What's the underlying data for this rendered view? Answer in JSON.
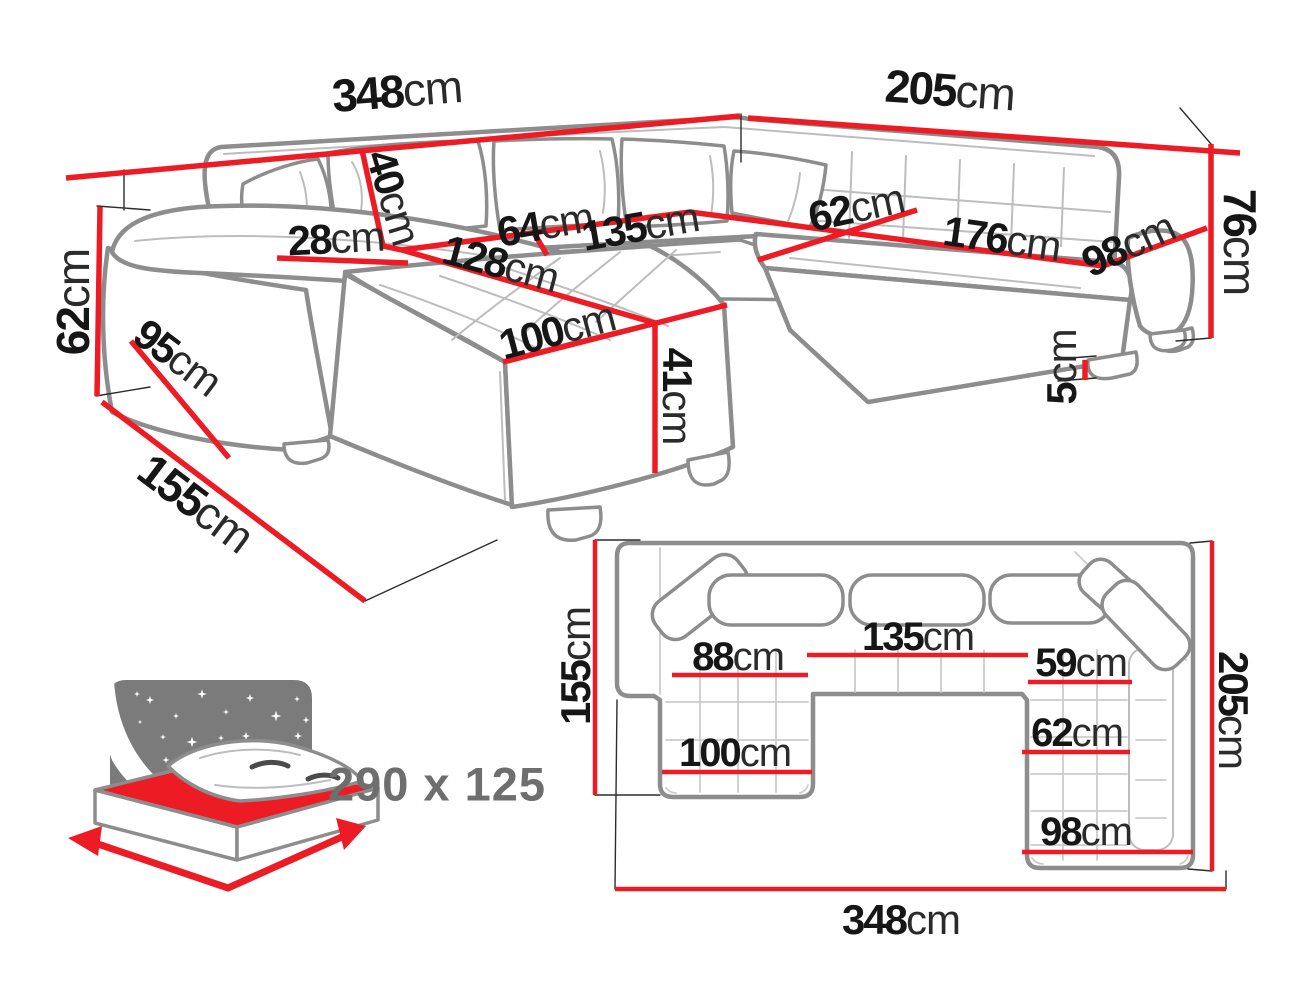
{
  "title": "corner-sofa-dimensions-diagram",
  "colors": {
    "dimension_red": "#ed1c24",
    "sofa_outline_gray": "#8d8d8d",
    "construction_line": "#2c2c2c",
    "label_text": "#161616",
    "icon_gray": "#7b7b7b",
    "icon_text_gray": "#6e6e6e",
    "background": "#ffffff"
  },
  "perspective": {
    "dims": [
      {
        "id": "width-left",
        "value": "348",
        "unit": "cm"
      },
      {
        "id": "width-right",
        "value": "205",
        "unit": "cm"
      },
      {
        "id": "height-back-right",
        "value": "76",
        "unit": "cm"
      },
      {
        "id": "height-arm-left",
        "value": "62",
        "unit": "cm"
      },
      {
        "id": "armrest-width",
        "value": "28",
        "unit": "cm"
      },
      {
        "id": "backrest-height",
        "value": "40",
        "unit": "cm"
      },
      {
        "id": "seat-depth-64",
        "value": "64",
        "unit": "cm"
      },
      {
        "id": "seat-width-135",
        "value": "135",
        "unit": "cm"
      },
      {
        "id": "corner-seat-62",
        "value": "62",
        "unit": "cm"
      },
      {
        "id": "seat-width-176",
        "value": "176",
        "unit": "cm"
      },
      {
        "id": "seat-width-98",
        "value": "98",
        "unit": "cm"
      },
      {
        "id": "chaise-length-128",
        "value": "128",
        "unit": "cm"
      },
      {
        "id": "arm-depth-95",
        "value": "95",
        "unit": "cm"
      },
      {
        "id": "chaise-width-100",
        "value": "100",
        "unit": "cm"
      },
      {
        "id": "seat-height-41",
        "value": "41",
        "unit": "cm"
      },
      {
        "id": "leg-height-5",
        "value": "5",
        "unit": "cm"
      },
      {
        "id": "depth-front-155",
        "value": "155",
        "unit": "cm"
      }
    ]
  },
  "plan": {
    "dims": [
      {
        "id": "plan-depth-left-155",
        "value": "155",
        "unit": "cm"
      },
      {
        "id": "plan-depth-right-205",
        "value": "205",
        "unit": "cm"
      },
      {
        "id": "plan-seat-88",
        "value": "88",
        "unit": "cm"
      },
      {
        "id": "plan-seat-135",
        "value": "135",
        "unit": "cm"
      },
      {
        "id": "plan-seat-59",
        "value": "59",
        "unit": "cm"
      },
      {
        "id": "plan-chaise-100",
        "value": "100",
        "unit": "cm"
      },
      {
        "id": "plan-seat-62",
        "value": "62",
        "unit": "cm"
      },
      {
        "id": "plan-seat-98",
        "value": "98",
        "unit": "cm"
      },
      {
        "id": "plan-width-348",
        "value": "348",
        "unit": "cm"
      }
    ]
  },
  "sleeping": {
    "label": "290 x 125"
  }
}
